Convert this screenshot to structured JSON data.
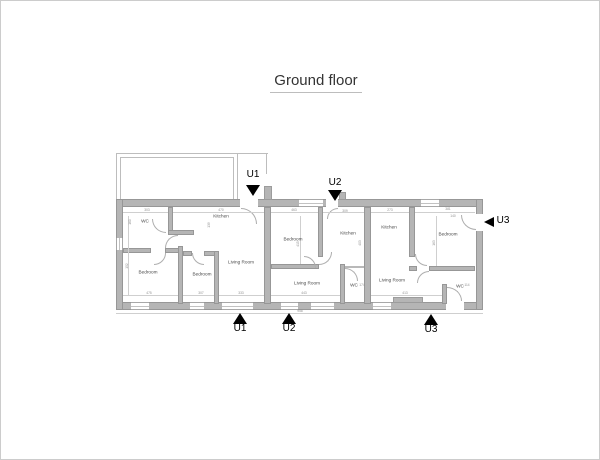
{
  "title": "Ground floor",
  "plan": {
    "wall_color": "#b5b5b5",
    "marker_color": "#000000",
    "rooms": [
      {
        "id": "unit1-wc",
        "label": "WC",
        "x": 144,
        "y": 220
      },
      {
        "id": "unit1-kitchen",
        "label": "Kitchen",
        "x": 220,
        "y": 215
      },
      {
        "id": "unit1-bedroom-1",
        "label": "Bedroom",
        "x": 147,
        "y": 271
      },
      {
        "id": "unit1-bedroom-2",
        "label": "Bedroom",
        "x": 201,
        "y": 273
      },
      {
        "id": "unit1-living-room",
        "label": "Living Room",
        "x": 240,
        "y": 261
      },
      {
        "id": "unit2-bedroom",
        "label": "Bedroom",
        "x": 292,
        "y": 238
      },
      {
        "id": "unit2-kitchen",
        "label": "Kitchen",
        "x": 347,
        "y": 232
      },
      {
        "id": "unit2-living-room",
        "label": "Living Room",
        "x": 306,
        "y": 282
      },
      {
        "id": "unit2-wc",
        "label": "WC",
        "x": 353,
        "y": 284
      },
      {
        "id": "unit3-kitchen",
        "label": "Kitchen",
        "x": 388,
        "y": 226
      },
      {
        "id": "unit3-bedroom",
        "label": "Bedroom",
        "x": 447,
        "y": 233
      },
      {
        "id": "unit3-living-room",
        "label": "Living Room",
        "x": 391,
        "y": 279
      },
      {
        "id": "unit3-wc",
        "label": "WC",
        "x": 459,
        "y": 285
      }
    ],
    "markers": [
      {
        "id": "u1-top",
        "label": "U1",
        "dir": "down",
        "lx": 244,
        "ly": 168,
        "tx": 245,
        "ty": 184
      },
      {
        "id": "u2-top",
        "label": "U2",
        "dir": "down",
        "lx": 326,
        "ly": 176,
        "tx": 327,
        "ty": 189
      },
      {
        "id": "u3-right",
        "label": "U3",
        "dir": "left",
        "lx": 494,
        "ly": 214,
        "tx": 483,
        "ty": 216
      },
      {
        "id": "u1-bottom",
        "label": "U1",
        "dir": "up",
        "lx": 231,
        "ly": 322,
        "tx": 232,
        "ty": 312
      },
      {
        "id": "u2-bottom",
        "label": "U2",
        "dir": "up",
        "lx": 280,
        "ly": 322,
        "tx": 281,
        "ty": 312
      },
      {
        "id": "u3-bottom",
        "label": "U3",
        "dir": "up",
        "lx": 422,
        "ly": 323,
        "tx": 423,
        "ty": 313
      }
    ],
    "dimensions": [
      {
        "text": "303",
        "x": 146,
        "y": 209
      },
      {
        "text": "470",
        "x": 220,
        "y": 209
      },
      {
        "text": "463",
        "x": 293,
        "y": 209
      },
      {
        "text": "309",
        "x": 344,
        "y": 210
      },
      {
        "text": "273",
        "x": 389,
        "y": 209
      },
      {
        "text": "381",
        "x": 447,
        "y": 208
      },
      {
        "text": "160",
        "x": 129,
        "y": 221,
        "vert": true
      },
      {
        "text": "139",
        "x": 208,
        "y": 224,
        "vert": true
      },
      {
        "text": "152",
        "x": 126,
        "y": 265,
        "vert": true
      },
      {
        "text": "415",
        "x": 297,
        "y": 243,
        "vert": true
      },
      {
        "text": "403",
        "x": 359,
        "y": 242,
        "vert": true
      },
      {
        "text": "163",
        "x": 433,
        "y": 242,
        "vert": true
      },
      {
        "text": "140",
        "x": 452,
        "y": 215
      },
      {
        "text": "475",
        "x": 148,
        "y": 292
      },
      {
        "text": "307",
        "x": 200,
        "y": 292
      },
      {
        "text": "333",
        "x": 240,
        "y": 292
      },
      {
        "text": "443",
        "x": 303,
        "y": 292
      },
      {
        "text": "413",
        "x": 404,
        "y": 292
      },
      {
        "text": "174",
        "x": 361,
        "y": 284
      },
      {
        "text": "114",
        "x": 466,
        "y": 284
      },
      {
        "text": "958",
        "x": 299,
        "y": 310
      }
    ]
  }
}
